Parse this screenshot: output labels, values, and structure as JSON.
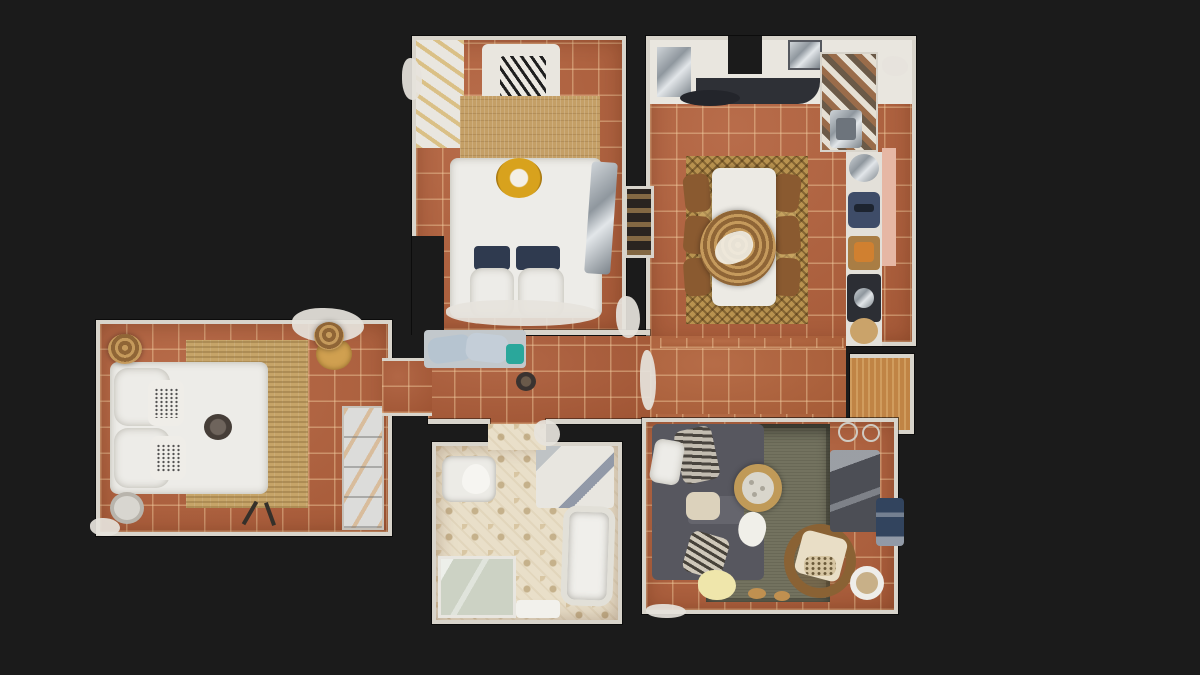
{
  "scene": {
    "type": "3d-dollhouse-floorplan",
    "description": "Top-down dollhouse view of a scanned apartment with terracotta tile floors on a dark background",
    "visible_text": "none"
  },
  "palette": {
    "background": "#1b1b1b",
    "wall": "#d8d4cb",
    "tile": "#b2603b",
    "tile_corridor": "#ab5a36",
    "tile_hall": "#b06038",
    "alcove_floor": "#c08445",
    "bath_floor": "#e9dfc9",
    "living_rug": "#73725f",
    "sofa": "#57575f",
    "sofa_seat": "#65656d",
    "bed_white": "#edece8",
    "gold": "#d8a21d",
    "navy_pillow": "#2f3a4f",
    "chevron_rug": "#b8924f",
    "jute_rug": "#c6a468",
    "wood_rug": "#c49f66",
    "pouf": "#d0a050",
    "teal_item": "#2aa79b",
    "pink_wall": "#e6b7a4",
    "counter_dark": "#2e3036",
    "navy_appliance": "#3e4c68",
    "dark_appliance": "#2c2e34",
    "wood_box": "#a97d44",
    "rattan": "#8a6234",
    "cream_cushion": "#e9dec6",
    "yellow_blanket": "#efe6ab",
    "leopard_cushion": "#d6c5a2",
    "blue_crate": "#32445e"
  },
  "rooms": [
    {
      "id": "bedroom-top",
      "label": "bedroom-top",
      "furniture": [
        "wardrobe",
        "zebra-bench",
        "wood-rug",
        "double-bed",
        "gold-pet-nest",
        "navy-pillows",
        "mirror-panel"
      ]
    },
    {
      "id": "kitchen-dining",
      "label": "kitchen-dining",
      "furniture": [
        "fridge-cabinet",
        "dark-countertop",
        "tiled-splashback",
        "sink",
        "appliance-column",
        "chevron-rug",
        "dining-table",
        "wicker-centerpiece",
        "dining-chairs"
      ]
    },
    {
      "id": "bedroom-left",
      "label": "bedroom-left",
      "furniture": [
        "double-bed",
        "printed-cushions",
        "jute-rug",
        "wicker-basket",
        "pouf",
        "shelving-unit",
        "round-side-table"
      ]
    },
    {
      "id": "bathroom",
      "label": "bathroom",
      "furniture": [
        "toilet",
        "vanity-sink",
        "bathtub",
        "shower-enclosure",
        "bath-mat",
        "patterned-tile-floor"
      ]
    },
    {
      "id": "living-room",
      "label": "living-room",
      "furniture": [
        "sectional-sofa",
        "striped-pillows",
        "round-coffee-table",
        "gray-rug",
        "rattan-armchair",
        "tv-console",
        "side-stool",
        "blue-crate"
      ]
    },
    {
      "id": "hallway",
      "label": "hallway",
      "furniture": [
        "cushioned-bench",
        "floor-object",
        "entrance-alcove",
        "wall-niche-shelf",
        "console-with-basket"
      ]
    }
  ]
}
